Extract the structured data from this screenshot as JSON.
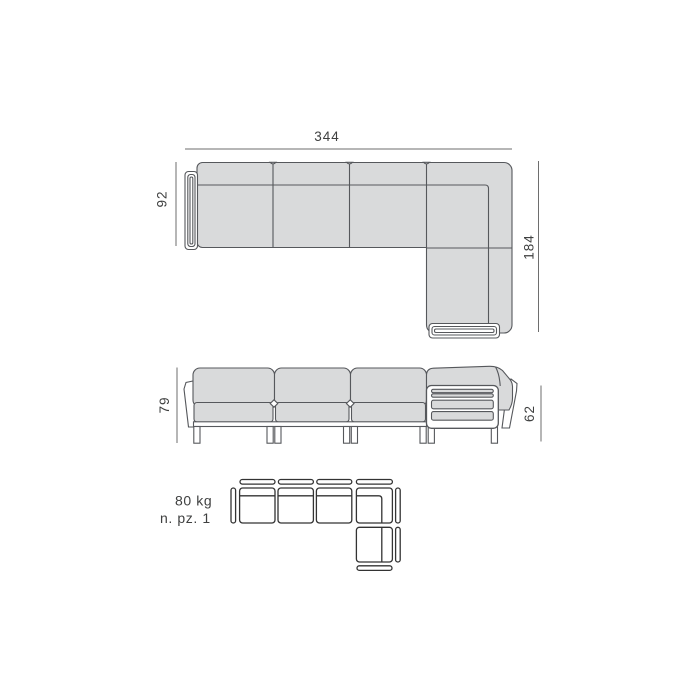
{
  "document": {
    "type": "furniture-dimension-sheet",
    "product": "modular L-shaped sectional sofa technical drawing"
  },
  "colors": {
    "background": "#ffffff",
    "cushion_fill": "#d9dadb",
    "outline": "#56585c",
    "dimension_line": "#6e6e6e",
    "text": "#3f4040",
    "icon_outline": "#333333"
  },
  "top_view": {
    "label": "top view",
    "width": "344",
    "left_depth": "92",
    "right_depth": "184"
  },
  "front_view": {
    "label": "front view",
    "height": "79",
    "arm_height": "62"
  },
  "specs": {
    "weight": "80 kg",
    "pieces": "n. pz. 1"
  },
  "module_icon": {
    "label": "modular-configuration-icon",
    "modules_in_row": 4,
    "modules_in_column_below_corner": 1
  }
}
